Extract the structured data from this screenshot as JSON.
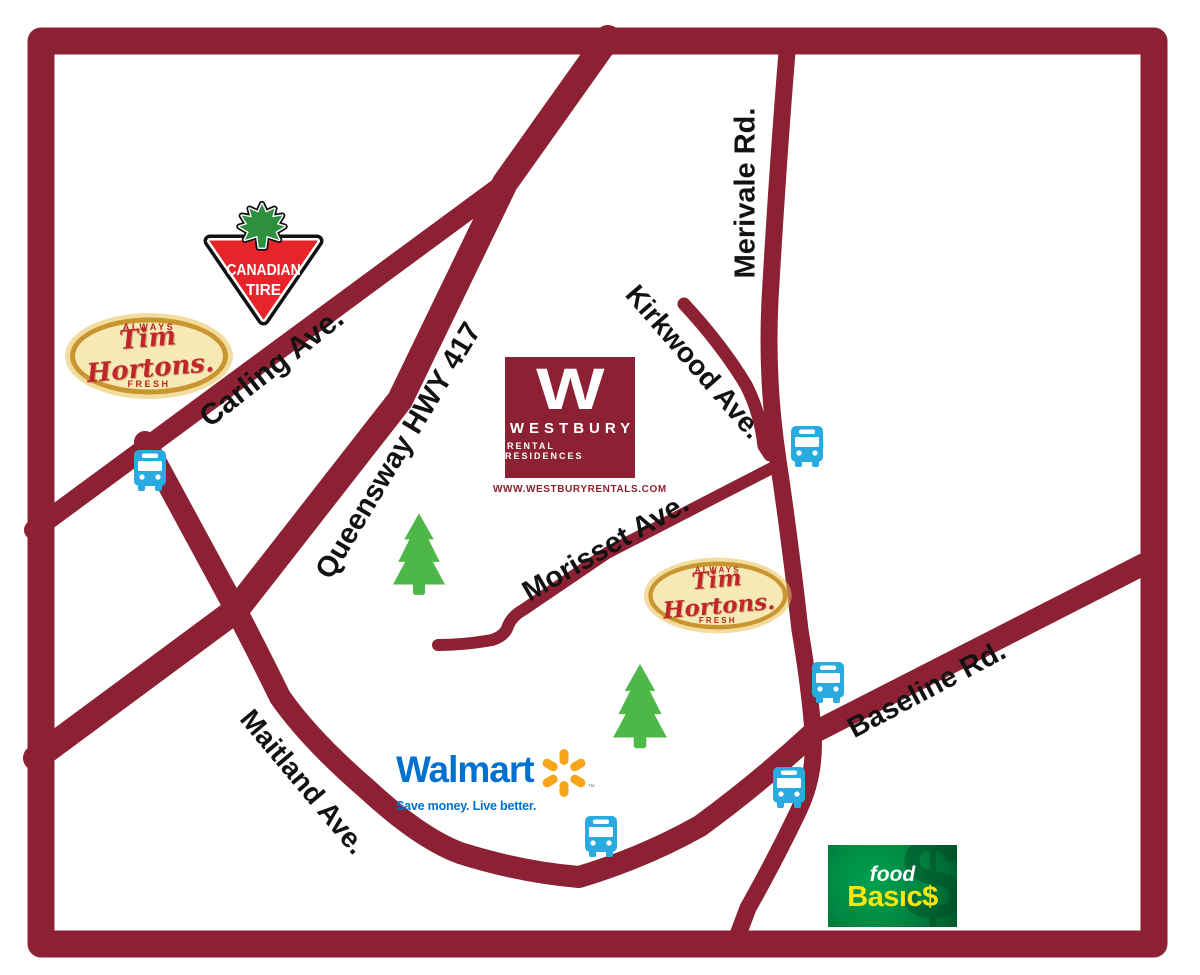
{
  "map": {
    "roads": {
      "carling": {
        "label": "Carling Ave."
      },
      "queensway": {
        "label": "Queensway HWY 417"
      },
      "merivale": {
        "label": "Merivale Rd."
      },
      "kirkwood": {
        "label": "Kirkwood Ave."
      },
      "morisset": {
        "label": "Morisset Ave."
      },
      "maitland": {
        "label": "Maitland Ave."
      },
      "baseline": {
        "label": "Baseline Rd."
      }
    },
    "logos": {
      "canadian_tire": {
        "line1": "CANADIAN",
        "line2": "TIRE"
      },
      "tim_hortons": {
        "top": "ALWAYS",
        "name": "Tim Hortons.",
        "bottom": "FRESH"
      },
      "westbury": {
        "monogram": "W",
        "name": "WESTBURY",
        "subtitle": "RENTAL RESIDENCES",
        "website": "WWW.WESTBURYRENTALS.COM"
      },
      "walmart": {
        "name": "Walmart",
        "tagline": "Save money. Live better.",
        "trademark": "™"
      },
      "food_basics": {
        "word1": "food",
        "word2": "Basıc$",
        "watermark": "$"
      }
    },
    "icons": {
      "bus": "bus-icon",
      "tree": "pine-tree-icon",
      "maple_leaf": "maple-leaf-icon",
      "spark": "walmart-spark-icon"
    },
    "colors": {
      "road_maroon": "#8C2133",
      "bus_blue": "#29ABE2",
      "tree_green": "#4DB848",
      "walmart_blue": "#0071CE",
      "spark_orange": "#F9A51B",
      "canadian_tire_red": "#E8242B",
      "canadian_tire_leaf": "#2E8F3E",
      "tim_hortons_red": "#C0272D",
      "tim_hortons_cream": "#F7E9B6",
      "tim_hortons_gold": "#C9952E",
      "food_basics_green": "#008843",
      "food_basics_yellow": "#FFE60A",
      "westbury_maroon": "#8C2133"
    }
  }
}
